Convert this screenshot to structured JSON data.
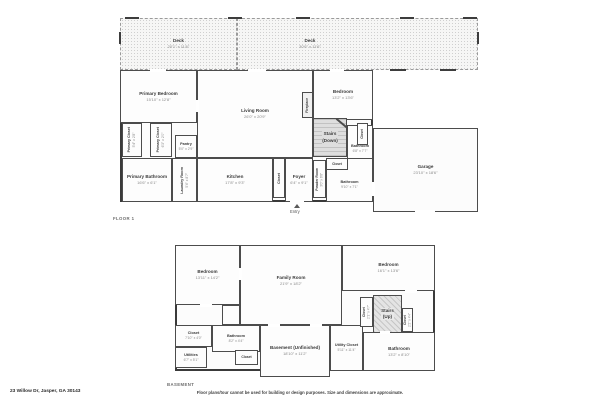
{
  "floor1": {
    "label": "FLOOR 1",
    "deck_left": {
      "name": "Deck",
      "dims": "20'1\" x 11'6\""
    },
    "deck_right": {
      "name": "Deck",
      "dims": "30'6\" x 11'6\""
    },
    "primary_bedroom": {
      "name": "Primary Bedroom",
      "dims": "15'10\" x 12'8\""
    },
    "living_room": {
      "name": "Living Room",
      "dims": "26'0\" x 20'9\""
    },
    "bedroom": {
      "name": "Bedroom",
      "dims": "13'2\" x 13'6\""
    },
    "fireplace": {
      "name": "Fireplace"
    },
    "primary_closet_1": {
      "name": "Primary Closet",
      "dims": "5'4\" x 2'8\""
    },
    "primary_closet_2": {
      "name": "Primary Closet",
      "dims": "6'3\" x 2'0\""
    },
    "pantry": {
      "name": "Pantry",
      "dims": "5'0\" x 2'9\""
    },
    "primary_bathroom": {
      "name": "Primary Bathroom",
      "dims": "16'6\" x 6'1\""
    },
    "laundry_room": {
      "name": "Laundry Room",
      "dims": "5'4\" x 8'7\""
    },
    "kitchen": {
      "name": "Kitchen",
      "dims": "17'8\" x 9'3\""
    },
    "closet_kitchen": {
      "name": "Closet"
    },
    "foyer": {
      "name": "Foyer",
      "dims": "6'4\" x 9'1\""
    },
    "powder_room": {
      "name": "Powder Room",
      "dims": "3'0\" x 6'8\""
    },
    "stairs": {
      "name": "Stairs",
      "sub": "(Down)"
    },
    "closet_bath": {
      "name": "Closet"
    },
    "bathroom_upper": {
      "name": "Bathroom",
      "dims": "6'8\" x 7'7\""
    },
    "closet_mid": {
      "name": "Closet"
    },
    "bathroom_lower": {
      "name": "Bathroom",
      "dims": "9'10\" x 7'1\""
    },
    "garage": {
      "name": "Garage",
      "dims": "23'10\" x 18'6\""
    },
    "entry": {
      "label": "Entry"
    }
  },
  "basement": {
    "label": "BASEMENT",
    "bedroom_left": {
      "name": "Bedroom",
      "dims": "13'11\" x 14'2\""
    },
    "family_room": {
      "name": "Family Room",
      "dims": "21'9\" x 18'2\""
    },
    "bedroom_right": {
      "name": "Bedroom",
      "dims": "16'1\" x 13'6\""
    },
    "closet_bl": {
      "name": "Closet",
      "dims": "7'10\" x 4'0\""
    },
    "utilities": {
      "name": "Utilities",
      "dims": "6'7\" x 5'1\""
    },
    "bathroom_bl": {
      "name": "Bathroom",
      "dims": "8'2\" x 4'4\""
    },
    "closet_small": {
      "name": "Closet"
    },
    "unfinished": {
      "name": "Basement (Unfinished)",
      "dims": "18'10\" x 11'2\""
    },
    "utility_closet": {
      "name": "Utility Closet",
      "dims": "5'11\" x 11'4\""
    },
    "closet_stairs_left": {
      "name": "Closet",
      "dims": "2'1\" x 4'7\""
    },
    "stairs": {
      "name": "Stairs",
      "sub": "(Up)"
    },
    "closet_stairs_right": {
      "name": "Closet",
      "dims": "2'2\" x 4'4\""
    },
    "bathroom_br": {
      "name": "Bathroom",
      "dims": "13'2\" x 8'10\""
    }
  },
  "footer": {
    "address": "23 Willow Dr, Jasper, GA 30143",
    "disclaimer": "Floor plans/tour cannot be used for building or design purposes. Size and dimensions are approximate."
  },
  "colors": {
    "wall": "#3a3a3a",
    "deck_fill": "#f6f6f5",
    "stairs_fill": "#dedede"
  }
}
